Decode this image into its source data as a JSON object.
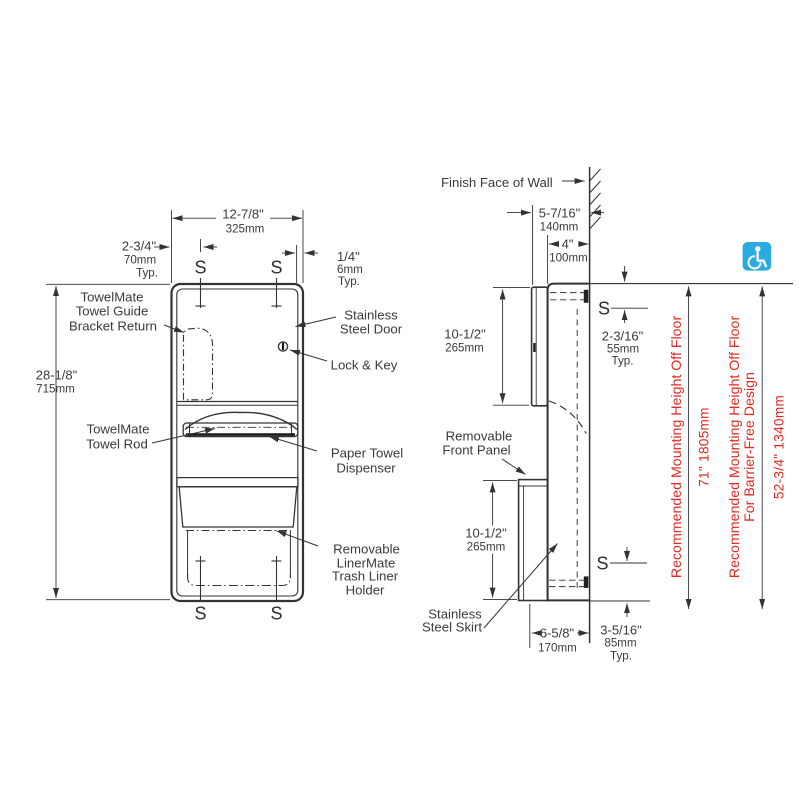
{
  "front_view": {
    "dim_width": {
      "in": "12-7/8\"",
      "mm": "325mm"
    },
    "dim_edge": {
      "in": "2-3/4\"",
      "mm": "70mm",
      "typ": "Typ."
    },
    "dim_gap": {
      "in": "1/4\"",
      "mm": "6mm",
      "typ": "Typ."
    },
    "dim_height": {
      "in": "28-1/8\"",
      "mm": "715mm"
    },
    "stud_letter": "S",
    "labels": {
      "towel_guide": [
        "TowelMate",
        "Towel Guide",
        "Bracket Return"
      ],
      "towel_rod": [
        "TowelMate",
        "Towel Rod"
      ],
      "door": [
        "Stainless",
        "Steel Door"
      ],
      "lock": "Lock & Key",
      "dispenser": [
        "Paper Towel",
        "Dispenser"
      ],
      "liner": [
        "Removable",
        "LinerMate",
        "Trash Liner",
        "Holder"
      ]
    }
  },
  "side_view": {
    "wall_label": "Finish Face of Wall",
    "dim_depth": {
      "in": "5-7/16\"",
      "mm": "140mm"
    },
    "dim_body": {
      "in": "4\"",
      "mm": "100mm"
    },
    "dim_upper": {
      "in": "10-1/2\"",
      "mm": "265mm"
    },
    "dim_lower": {
      "in": "10-1/2\"",
      "mm": "265mm"
    },
    "dim_stud_top": {
      "in": "2-3/16\"",
      "mm": "55mm",
      "typ": "Typ."
    },
    "dim_stud_bottom": {
      "in": "3-5/16\"",
      "mm": "85mm",
      "typ": "Typ."
    },
    "dim_skirt": {
      "in": "6-5/8\"",
      "mm": "170mm"
    },
    "stud_letter": "S",
    "labels": {
      "front_panel": [
        "Removable",
        "Front Panel"
      ],
      "skirt": [
        "Stainless",
        "Steel Skirt"
      ]
    }
  },
  "mounting_notes": {
    "standard": {
      "label": "Recommended Mounting Height Off Floor",
      "value": "71\"  1805mm"
    },
    "barrier_free": {
      "label": [
        "Recommended Mounting Height Off Floor",
        "For Barrier-Free Design"
      ],
      "value": "52-3/4\"  1340mm"
    }
  },
  "accessibility_icon": {
    "name": "wheelchair-accessible-icon",
    "color": "#29ABE2"
  },
  "colors": {
    "line": "#333333",
    "text": "#3a3a3a",
    "note_red": "#e02a22",
    "icon_blue": "#29ABE2"
  }
}
